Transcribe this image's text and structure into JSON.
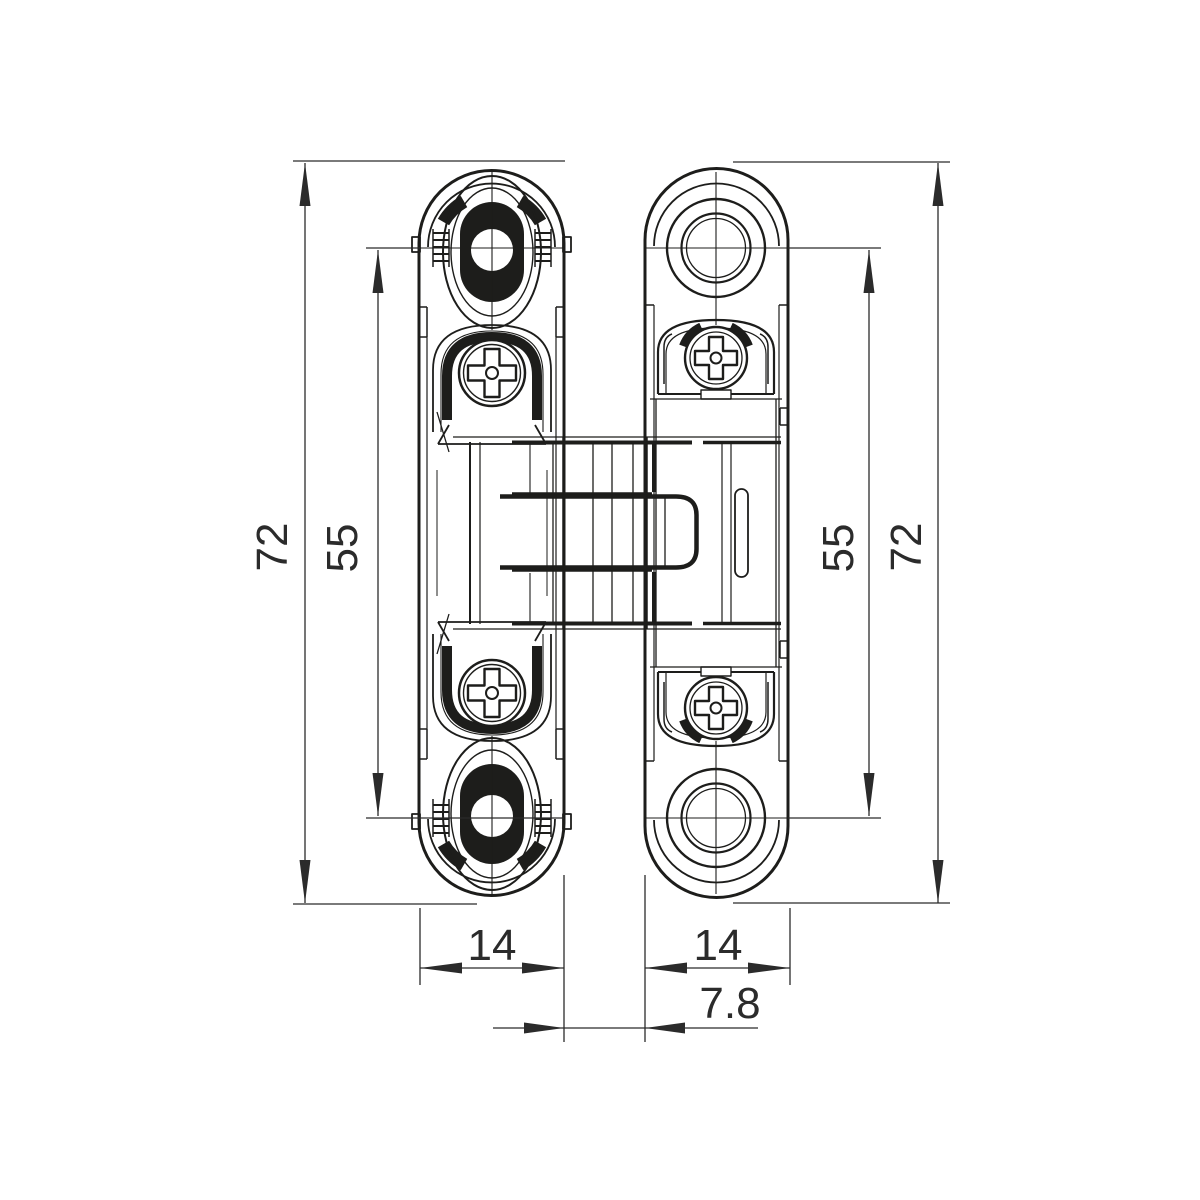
{
  "drawing": {
    "kind": "technical-dimension-drawing",
    "subject": "concealed-hinge-front-view",
    "background_color": "#ffffff",
    "line_color": "#1d1d1b",
    "text_color": "#2b2b2b",
    "dimensions": {
      "left_outer_height": "72",
      "left_hole_spacing": "55",
      "right_hole_spacing": "55",
      "right_outer_height": "72",
      "left_plate_width": "14",
      "right_plate_width": "14",
      "center_gap": "7.8"
    }
  }
}
